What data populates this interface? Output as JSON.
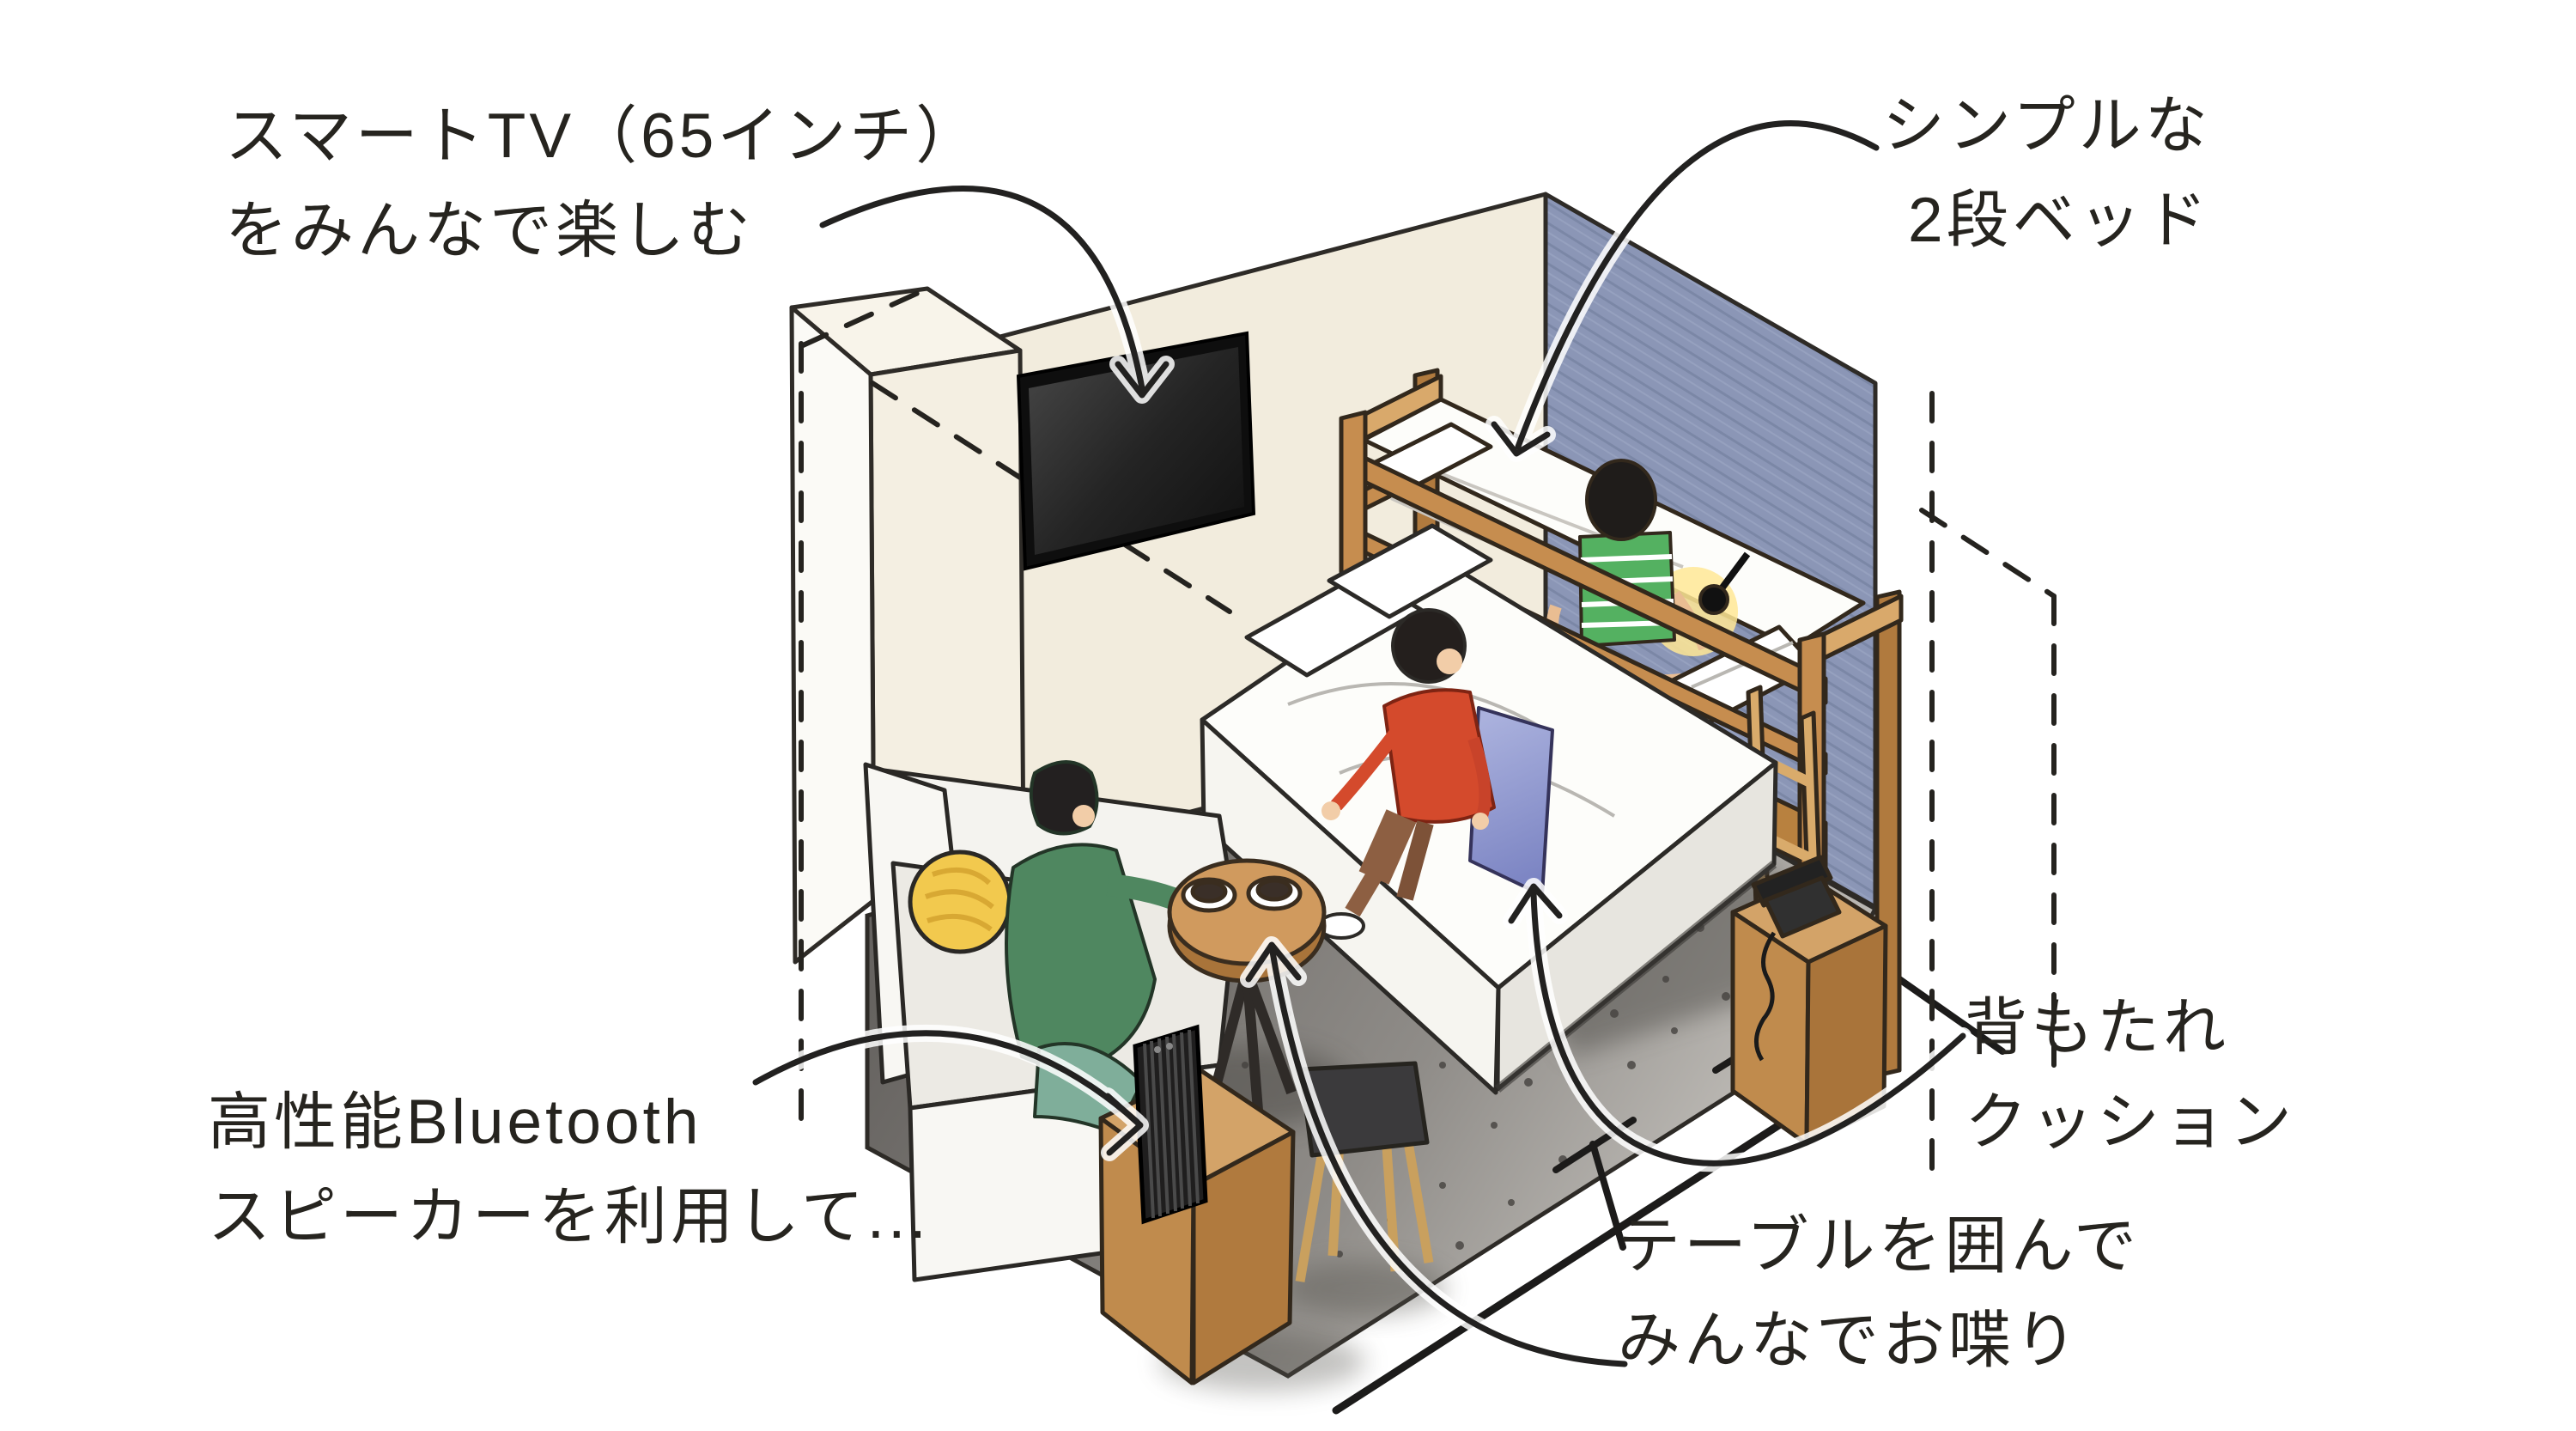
{
  "page": {
    "background": "#ffffff",
    "kind": "hand-drawn isometric hotel room illustration"
  },
  "annotations": {
    "smart_tv": {
      "line1": "スマートTV（65インチ）",
      "line2": "をみんなで楽しむ"
    },
    "bunk_bed": {
      "line1": "シンプルな",
      "line2": "2段ベッド"
    },
    "bluetooth_speaker": {
      "line1": "高性能Bluetooth",
      "line2": "スピーカーを利用して..."
    },
    "backrest_cushion": {
      "line1": "背もたれ",
      "line2": "クッション"
    },
    "table_chat": {
      "line1": "テーブルを囲んで",
      "line2": "みんなでお喋り"
    }
  },
  "colors": {
    "wall_cream": "#f2ecdd",
    "wall_blue": "#8b96b6",
    "carpet_dark": "#6b6864",
    "carpet_light": "#cbc8c3",
    "wood": "#c68d4f",
    "wood_light": "#d9a96b",
    "wood_dark": "#a9743a",
    "tv_screen": "#1d1d1d",
    "sofa_white": "#f6f5f1",
    "cushion_yellow": "#f2c94e",
    "cushion_blue": "#9aa3d6",
    "sweater_green": "#4f8760",
    "shirt_green": "#54b161",
    "top_red": "#d44a2c",
    "outline": "#2e2b27"
  }
}
